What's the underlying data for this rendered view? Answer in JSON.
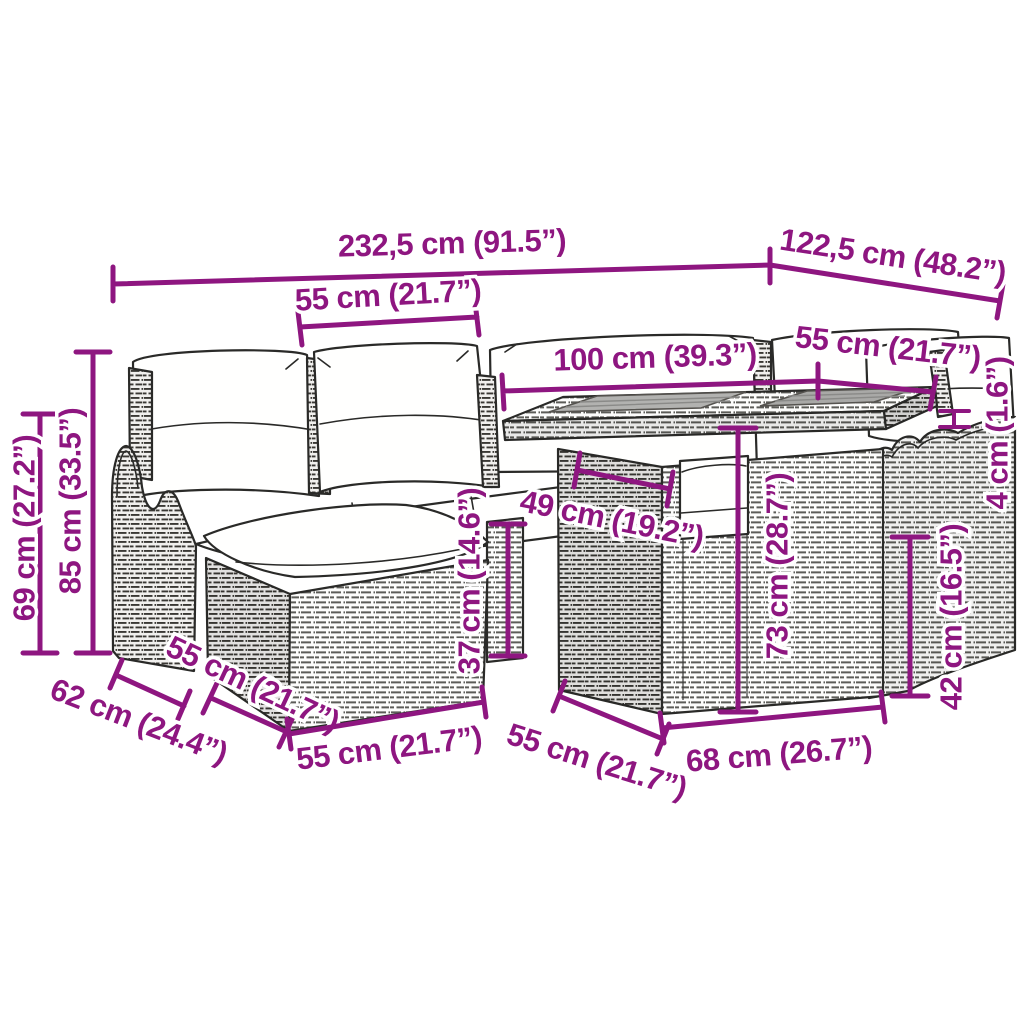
{
  "diagram": {
    "type": "product-dimension-diagram",
    "product": "rattan garden lounge set with corner sofa, footstool and table"
  },
  "colors": {
    "dimension": "#8E1680",
    "outline": "#2a2a28",
    "background": "#ffffff"
  },
  "dimensions": {
    "overall_width": {
      "label": "232,5 cm (91.5”)"
    },
    "overall_depth": {
      "label": "122,5 cm (48.2”)"
    },
    "left_seat_width": {
      "label": "55 cm (21.7”)"
    },
    "table_length": {
      "label": "100 cm (39.3”)"
    },
    "right_seat_width": {
      "label": "55 cm (21.7”)"
    },
    "tabletop_thickness": {
      "label": "4 cm (1.6”)"
    },
    "right_seat_height": {
      "label": "42 cm (16.5”)"
    },
    "table_height": {
      "label": "73 cm (28.7”)"
    },
    "footstool_height": {
      "label": "37 cm (14.6”)"
    },
    "seat_depth": {
      "label": "49 cm (19.2”)"
    },
    "armrest_height": {
      "label": "69 cm (27.2”)"
    },
    "back_height": {
      "label": "85 cm (33.5”)"
    },
    "armrest_depth": {
      "label": "62 cm (24.4”)"
    },
    "footstool_depth": {
      "label": "55 cm (21.7”)"
    },
    "footstool_width": {
      "label": "55 cm (21.7”)"
    },
    "table_depth": {
      "label": "55 cm (21.7”)"
    },
    "table_base_width": {
      "label": "68 cm (26.7”)"
    }
  }
}
